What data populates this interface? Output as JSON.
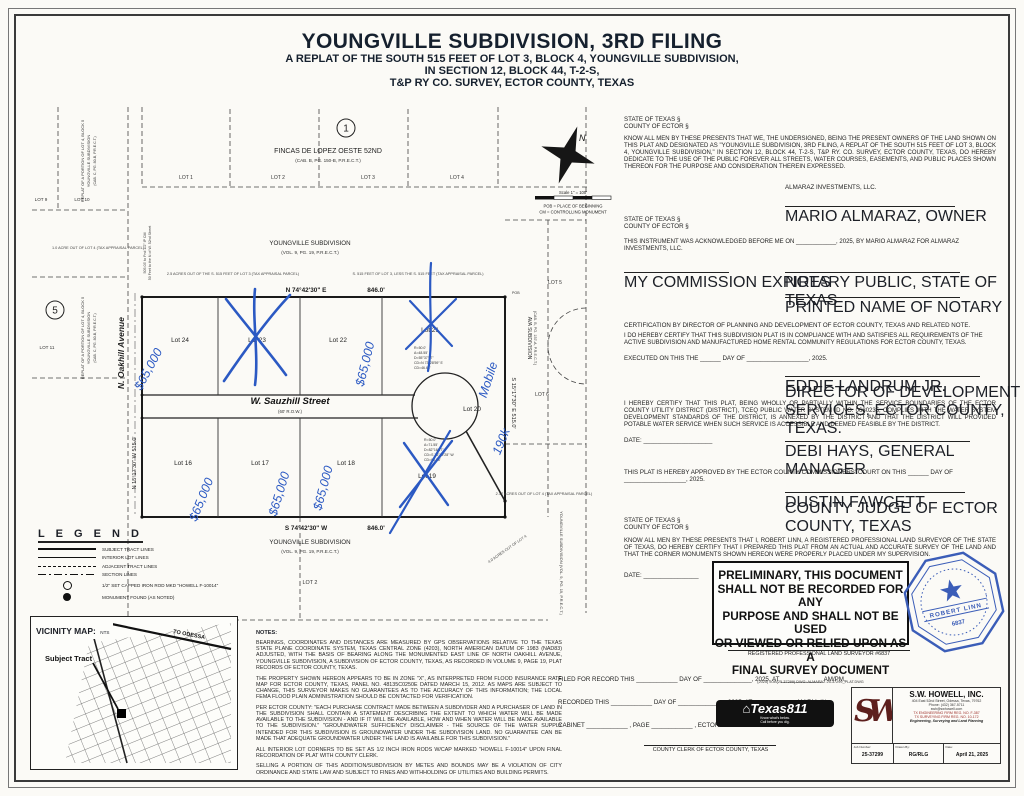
{
  "title": {
    "main": "YOUNGVILLE SUBDIVISION, 3RD FILING",
    "sub1": "A REPLAT OF THE SOUTH 515 FEET OF LOT 3, BLOCK 4, YOUNGVILLE SUBDIVISION,",
    "sub2": "IN SECTION 12, BLOCK 44, T-2-S,",
    "sub3": "T&P RY CO. SURVEY, ECTOR COUNTY, TEXAS"
  },
  "plat": {
    "marker1": "1",
    "marker5": "5",
    "fincas_name": "FINCAS DE LOPEZ OESTE 52ND",
    "fincas_rec": "(CAB. B, PG. 150-B, P.R.E.C.T.)",
    "youngville_top": "YOUNGVILLE SUBDIVISION",
    "youngville_top_rec": "(VOL. 9, PG. 19, P.R.E.C.T.)",
    "youngville_bottom": "YOUNGVILLE SUBDIVISION",
    "youngville_bottom_rec": "(VOL. 9, PG. 19, P.R.E.C.T.)",
    "ava_name": "AVA SUBDIVISION",
    "ava_rec": "(CAB. B, PG. 157-A, P.R.E.C.T.)",
    "replat_1": "REPLAT OF A PORTION OF LOT 4, BLOCK 5",
    "replat_2": "YOUNGVILLE SUBDIVISION",
    "replat_3": "(CAB. C, PG. 80-B, P.R.E.C.T.)",
    "youngville_right_vert": "YOUNGVILLE SUBDIVISION (VOL. 9, PG. 19, P.R.E.C.T.)",
    "street_oakhill": "N. Oakhill Avenue",
    "street_sauzhill": "W. Sauzhill Street",
    "street_row": "(60' R.O.W.)",
    "bearing_top": "N 74°42'30\" E",
    "dist_top": "846.0'",
    "bearing_bottom": "S 74°42'30\" W",
    "dist_bottom": "846.0'",
    "bearing_left": "N 15°17'30\" W    515.0'",
    "bearing_right": "S 15°17'30\" E    515.0'",
    "lots_top_adj": [
      "LOT 1",
      "LOT 2",
      "LOT 3",
      "LOT 4"
    ],
    "lots_left_adj": [
      "LOT 9",
      "LOT 10",
      "LOT 11"
    ],
    "lots_right_adj": [
      "LOT 5",
      "LOT 6"
    ],
    "lot_bottom_adj": "LOT 2",
    "lots": {
      "l16": "Lot 16",
      "l17": "Lot 17",
      "l18": "Lot 18",
      "l19": "Lot 19",
      "l20": "Lot 20",
      "l21": "Lot 21",
      "l22": "Lot 22",
      "l23": "Lot 23",
      "l24": "Lot 24"
    },
    "north": "N",
    "scale": "Scale 1\" = 100'",
    "pob_def": "POB = PLACE OF BEGINNING",
    "cm_def": "CM = CONTROLLING MONUMENT",
    "pob_label": "POB",
    "note_25ac": "2.5 ACRES OUT OF THE S. 515 FEET OF LOT 3 (TAX APPRAISAL PARCEL)",
    "note_515": "S. 515 FEET OF LOT 3, LESS THE S. 515 FEET (TAX APPRAISAL PARCEL)",
    "note_1ac": "1.0 ACRE OUT OF LOT 4 (TAX APPRAISAL PARCEL)",
    "note_217ac": "2.17 ACRES OUT OF LOT 4 (TAX APPRAISAL PARCEL)",
    "note_4ac": "4.0 ACRES OUT OF LOT 4",
    "edge_note_1": "505.03' to Fnd 1/2\" IP CM",
    "edge_note_2": "50 Feet to the N of W. 52nd Street",
    "curve1": [
      "R=50.0'",
      "A=48.55'",
      "D=55°37'57\"",
      "CD=N 73°28'59\" E",
      "CD=46.68'"
    ],
    "curve2": [
      "R=50.0'",
      "A=71.55'",
      "D=82°16'47\"",
      "CD=S 76°12'28\" W",
      "CD=65.58'"
    ]
  },
  "handwriting": {
    "price": "$65,000",
    "mobile": "Mobile",
    "price_190": "190k"
  },
  "legend": {
    "title": "L E G E N D",
    "items": [
      "SUBJECT TRACT LINES",
      "INTERIOR LOT LINES",
      "ADJACENT TRACT LINES",
      "SECTION LINES",
      "1/2\" SET CAPPED IRON ROD MKD \"HOWELL F-10014\"",
      "MONUMENT FOUND (AS NOTED)"
    ]
  },
  "vicinity": {
    "title": "VICINITY MAP:",
    "nts": "NTS",
    "subject": "Subject Tract",
    "to_odessa": "TO ODESSA"
  },
  "notes": {
    "title": "NOTES:",
    "p1": "BEARINGS, COORDINATES AND DISTANCES ARE MEASURED BY GPS OBSERVATIONS RELATIVE TO THE TEXAS STATE PLANE COORDINATE SYSTEM, TEXAS CENTRAL ZONE (4203), NORTH AMERICAN DATUM OF 1983 (NAD83) ADJUSTED, WITH THE BASIS OF BEARING ALONG THE MONUMENTED EAST LINE OF NORTH OAKHILL AVENUE, YOUNGVILLE SUBDIVISION, A SUBDIVISION OF ECTOR COUNTY, TEXAS, AS RECORDED IN VOLUME 9, PAGE 19, PLAT RECORDS OF ECTOR COUNTY, TEXAS.",
    "p2": "THE PROPERTY SHOWN HEREON APPEARS TO BE IN ZONE \"X\", AS INTERPRETED FROM FLOOD INSURANCE RATE MAP FOR ECTOR COUNTY, TEXAS, PANEL NO. 48135C0250E DATED MARCH 15, 2012. AS MAPS ARE SUBJECT TO CHANGE, THIS SURVEYOR MAKES NO GUARANTEES AS TO THE ACCURACY OF THIS INFORMATION; THE LOCAL FEMA FLOOD PLAIN ADMINISTRATION SHOULD BE CONTACTED FOR VERIFICATION.",
    "p3": "PER ECTOR COUNTY: \"EACH PURCHASE CONTRACT MADE BETWEEN A SUBDIVIDER AND A PURCHASER OF LAND IN THE SUBDIVISION SHALL CONTAIN A STATEMENT DESCRIBING THE EXTENT TO WHICH WATER WILL BE MADE AVAILABLE TO THE SUBDIVISION - AND IF IT WILL BE AVAILABLE, HOW AND WHEN WATER WILL BE MADE AVAILABLE TO THE SUBDIVISION.\" \"GROUNDWATER SUFFICIENCY DISCLAIMER - THE SOURCE OF THE WATER SUPPLY INTENDED FOR THIS SUBDIVISION IS GROUNDWATER UNDER THE SUBDIVISION LAND. NO GUARANTEE CAN BE MADE THAT ADEQUATE GROUNDWATER UNDER THE LAND IS AVAILABLE FOR THIS SUBDIVISION.\"",
    "p4": "ALL INTERIOR LOT CORNERS TO BE SET AS 1/2 INCH IRON RODS W/CAP MARKED \"HOWELL F-10014\" UPON FINAL RECORDATION OF PLAT WITH COUNTY CLERK.",
    "p5": "SELLING A PORTION OF THIS ADDITION/SUBDIVISION BY METES AND BOUNDS MAY BE A VIOLATION OF CITY ORDINANCE AND STATE LAW AND SUBJECT TO FINES AND WITHHOLDING OF UTILITIES AND BUILDING PERMITS."
  },
  "dedication": {
    "state": "STATE OF TEXAS §",
    "county": "COUNTY OF ECTOR §",
    "body": "KNOW ALL MEN BY THESE PRESENTS THAT WE, THE UNDERSIGNED, BEING THE PRESENT OWNERS OF THE LAND SHOWN ON THIS PLAT AND DESIGNATED AS \"YOUNGVILLE SUBDIVISION, 3RD FILING, A REPLAT OF THE SOUTH 515 FEET OF LOT 3, BLOCK 4, YOUNGVILLE SUBDIVISION,\" IN SECTION 12, BLOCK 44, T-2-S, T&P RY. CO. SURVEY, ECTOR COUNTY, TEXAS, DO HEREBY DEDICATE TO THE USE OF THE PUBLIC FOREVER ALL STREETS, WATER COURSES, EASEMENTS, AND PUBLIC PLACES SHOWN THEREON FOR THE PURPOSE AND CONSIDERATION THEREIN EXPRESSED.",
    "company": "ALMARAZ INVESTMENTS, LLC.",
    "owner_sig": "MARIO ALMARAZ, OWNER"
  },
  "notary": {
    "state": "STATE OF TEXAS §",
    "county": "COUNTY OF ECTOR §",
    "ack": "THIS INSTRUMENT WAS ACKNOWLEDGED BEFORE ME ON ____________, 2025, BY MARIO ALMARAZ FOR ALMARAZ INVESTMENTS, LLC.",
    "commission": "MY COMMISSION EXPIRES",
    "notary_public": "NOTARY PUBLIC, STATE OF TEXAS",
    "printed_name": "PRINTED NAME OF NOTARY"
  },
  "planning_cert": {
    "title": "CERTIFICATION BY DIRECTOR OF PLANNING AND DEVELOPMENT OF ECTOR COUNTY, TEXAS AND RELATED NOTE.",
    "body": "I DO HEREBY CERTIFY THAT THIS SUBDIVISION PLAT IS IN COMPLIANCE WITH AND SATISFIES ALL REQUIREMENTS OF THE ACTIVE SUBDIVISION AND MANUFACTURED HOME RENTAL COMMUNITY REGULATIONS FOR ECTOR COUNTY, TEXAS.",
    "executed": "EXECUTED ON THIS THE ______ DAY OF __________________, 2025.",
    "name": "EDDIE LANDRUM JR.",
    "role": "DIRECTOR OF DEVELOPMENT SERVICES, ECTOR COUNTY, TEXAS."
  },
  "water_cert": {
    "body": "I HEREBY CERTIFY THAT THIS PLAT, BEING WHOLLY OR PARTIALLY WITHIN THE SERVICE BOUNDARIES OF THE ECTOR COUNTY UTILITY DISTRICT (DISTRICT), TCEQ PUBLIC WATER SYSTEM ID NO. 0680235, COMPLIES WITH THE WATER SYSTEM DEVELOPMENT STANDARDS OF THE DISTRICT, IS ANNEXED BY THE DISTRICT AND THAT THE DISTRICT WILL PROVIDED POTABLE WATER SERVICE WHEN SUCH SERVICE IS ACCESSIBLE AND DEEMED FEASIBLE BY THE DISTRICT.",
    "date_label": "DATE: ____________________",
    "manager": "DEBI HAYS, GENERAL MANAGER"
  },
  "court": {
    "body": "THIS PLAT IS HEREBY APPROVED BY THE ECTOR COUNTY COMMISSIONERS' COURT ON THIS ______ DAY OF __________________, 2025.",
    "judge": "DUSTIN FAWCETT",
    "judge_role": "COUNTY JUDGE OF ECTOR COUNTY, TEXAS"
  },
  "surveyor": {
    "state": "STATE OF TEXAS §",
    "county": "COUNTY OF ECTOR §",
    "body": "KNOW ALL MEN BY THESE PRESENTS THAT I, ROBERT LINN, A REGISTERED PROFESSIONAL LAND SURVEYOR OF THE STATE OF TEXAS, DO HEREBY CERTIFY THAT I PREPARED THIS PLAT FROM AN ACTUAL AND ACCURATE SURVEY OF THE LAND AND THAT THE CORNER MONUMENTS SHOWN HEREON WERE PROPERLY PLACED UNDER MY SUPERVISION.",
    "date_label": "DATE: ________________",
    "reg_line": "REGISTERED PROFESSIONAL LAND SURVEYOR #6837",
    "seal_name": "ROBERT LINN",
    "seal_number": "6837"
  },
  "preliminary": {
    "l1": "PRELIMINARY, THIS DOCUMENT",
    "l2": "SHALL NOT BE RECORDED FOR ANY",
    "l3": "PURPOSE AND SHALL NOT BE USED",
    "l4": "OR VIEWED OR RELIED UPON AS A",
    "l5": "FINAL SURVEY DOCUMENT",
    "fine": "(2025) JOB(25-37299) DWG: ALMARAZ 25-37299_PLAT.DWG"
  },
  "record": {
    "filed": "FILED FOR RECORD THIS ____________ DAY OF ______________, 2025, AT ____________ AM/PM,",
    "recorded": "RECORDED THIS ____________ DAY OF ______________ 2025, AT ____________ AM/PM, IN",
    "cabinet": "CABINET ____________ , PAGE ____________ , ECTOR COUNTY PLAT RECORDS.",
    "clerk": "COUNTY CLERK OF ECTOR COUNTY, TEXAS"
  },
  "texas811": {
    "name": "Texas811",
    "tag1": "Know what's below.",
    "tag2": "Call before you dig."
  },
  "firm": {
    "logo": "SWH",
    "name": "S.W. HOWELL, INC.",
    "addr1": "404 East 52nd Street, Odessa, Texas, 79762",
    "addr2": "Phone: (432) 367-5711",
    "addr3": "swh@swhowell.com",
    "addr4": "TX ENGINEERING FIRM REG. NO. F-387",
    "addr5": "TX SURVEYING FIRM REG. NO. 10-172",
    "addr6": "Engineering, Surveying and Land Planning",
    "job_label": "Job Number:",
    "job": "25-37299",
    "drawn_label": "Drawn By:",
    "drawn": "RG/RLG",
    "date_label": "Date:",
    "date": "April 21, 2025"
  }
}
